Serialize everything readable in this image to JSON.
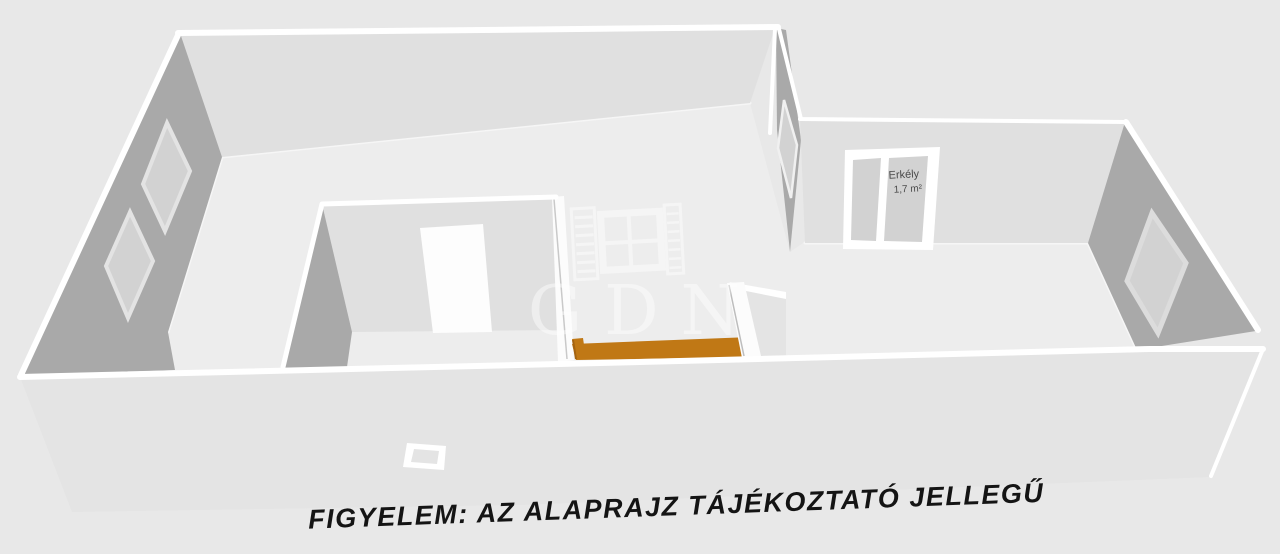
{
  "caption": {
    "text": "FIGYELEM: AZ ALAPRAJZ TÁJÉKOZTATÓ JELLEGŰ"
  },
  "watermark": {
    "text": "GDN"
  },
  "labels": {
    "balcony_name": "Erkély",
    "balcony_area": "1,7 m²"
  },
  "colors": {
    "background": "#e8e8e8",
    "floor": "#ededed",
    "wall_light": "#e0e0e0",
    "wall_dark": "#a9a9a9",
    "wall_front": "#e4e4e4",
    "wall_white": "#fcfcfc",
    "window_pane": "#d2d2d2",
    "door_white": "#fdfdfd",
    "counter_orange": "#c07815",
    "counter_orange_dark": "#a46310",
    "pure_white": "#ffffff",
    "caption_text": "#141414",
    "label_text": "#4a4a4a"
  }
}
